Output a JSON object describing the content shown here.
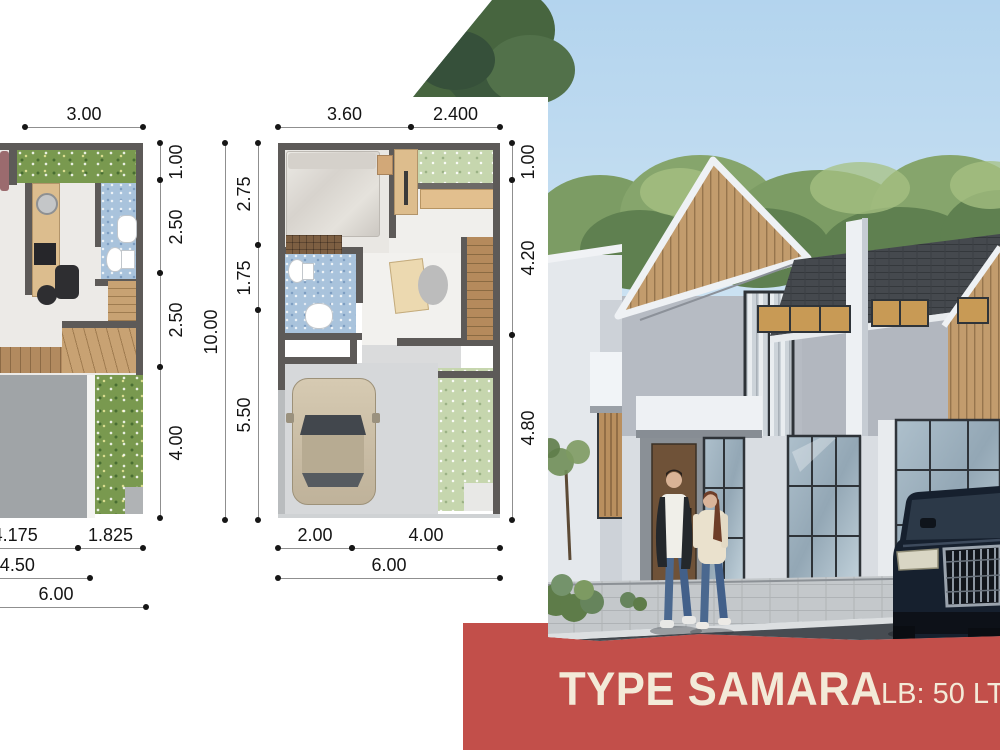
{
  "brochure": {
    "banner": {
      "title": "TYPE SAMARA",
      "area_info": "LB: 50 LT",
      "bg_color": "#c24f4a",
      "text_color": "#f3ead8"
    },
    "floorplan_first": {
      "dims_top": [
        "3.00"
      ],
      "dims_right": [
        "1.00",
        "2.50",
        "2.50",
        "4.00"
      ],
      "dims_bottom_row1": [
        "4.175",
        "1.825"
      ],
      "dims_bottom_row2": [
        "4.50"
      ],
      "dims_bottom_total": "6.00"
    },
    "floorplan_second": {
      "dims_top": [
        "3.60",
        "2.400"
      ],
      "dims_left": [
        "2.75",
        "1.75",
        "5.50"
      ],
      "dims_left_total": "10.00",
      "dims_right": [
        "1.00",
        "4.20",
        "4.80"
      ],
      "dims_bottom": [
        "2.00",
        "4.00"
      ],
      "dims_bottom_total": "6.00"
    },
    "colors": {
      "wall_gray": "#5d5a58",
      "wood": "#c9a06c",
      "garden_green": "#79994f",
      "bathroom_blue": "#a9c3dc",
      "sky_blue": "#b7d6ee",
      "roof_dark": "#45494e",
      "banner_red": "#c24f4a",
      "banner_cream": "#f3ead8"
    }
  }
}
